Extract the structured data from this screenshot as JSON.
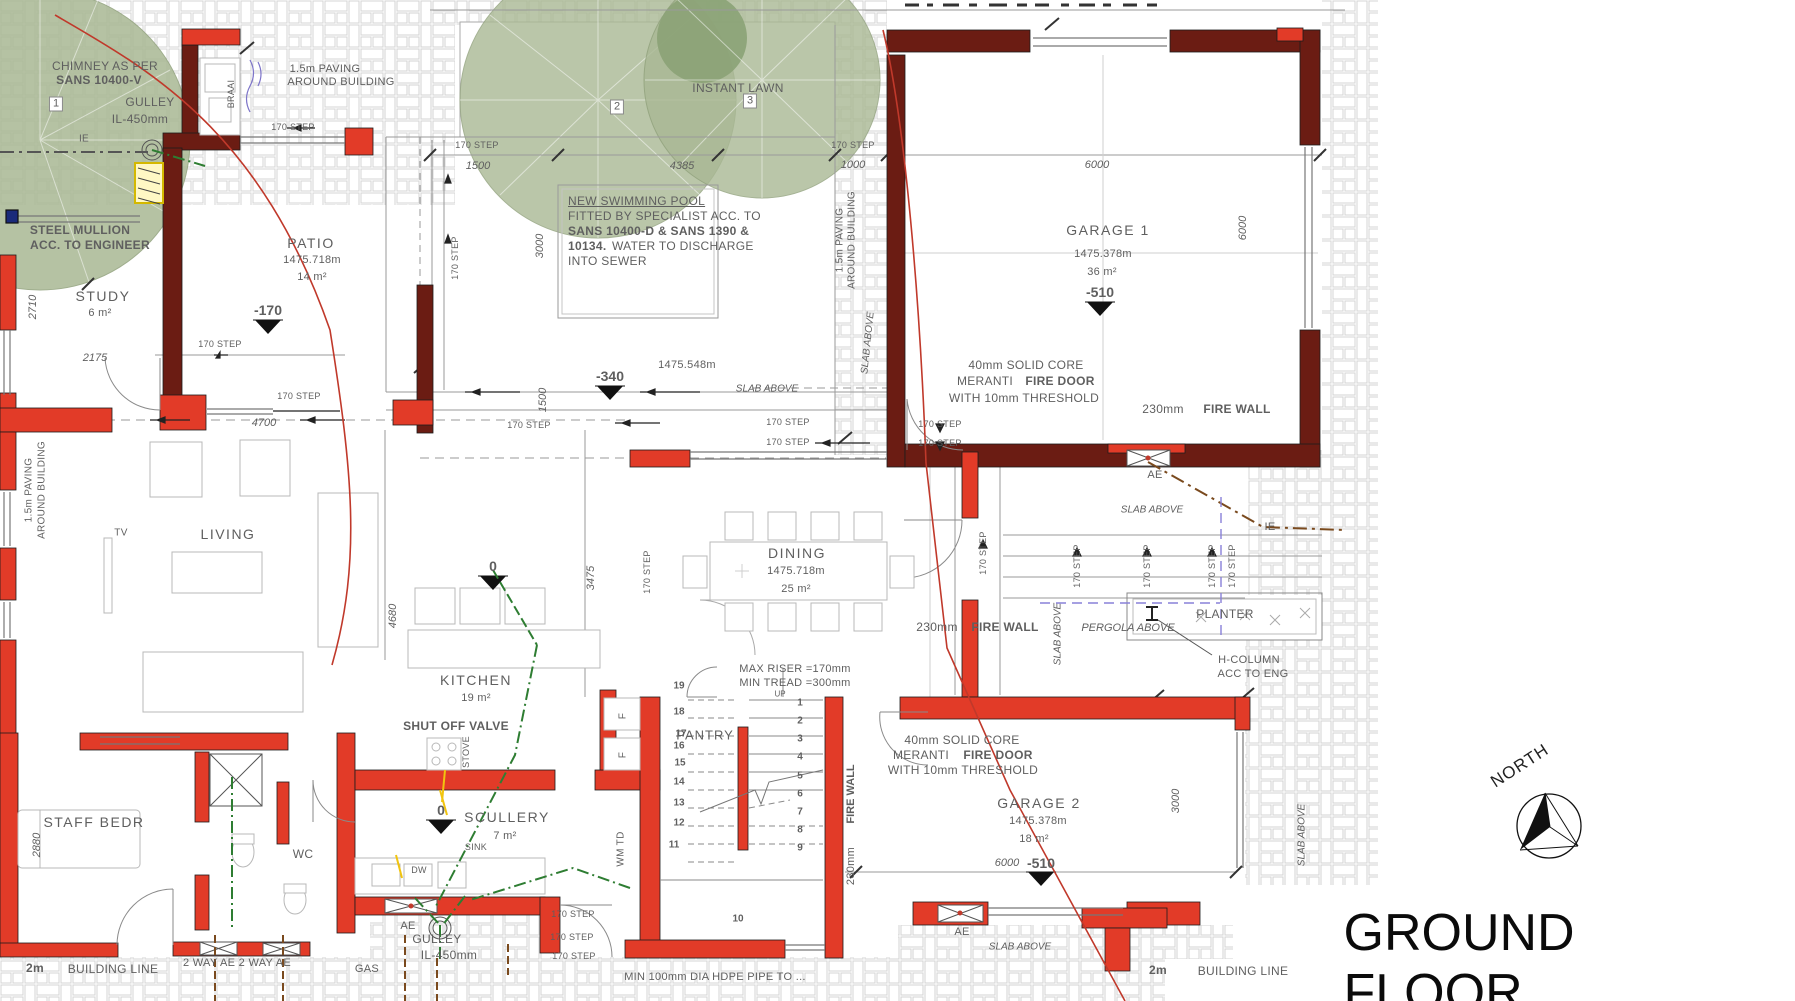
{
  "title": "GROUND FLOOR",
  "north_label": "NORTH",
  "labels": [
    {
      "n": "chimney-note-1",
      "t": "CHIMNEY AS PER",
      "x": 105,
      "y": 66,
      "c": "g12"
    },
    {
      "n": "chimney-note-2",
      "t": "SANS 10400-V",
      "x": 99,
      "y": 80,
      "c": "b12"
    },
    {
      "n": "gulley-1",
      "t": "GULLEY",
      "x": 150,
      "y": 102,
      "c": "g12"
    },
    {
      "n": "gulley-1-il",
      "t": "IL-450mm",
      "x": 140,
      "y": 119,
      "c": "g12"
    },
    {
      "n": "tree-1-tag",
      "t": "1",
      "x": 56,
      "y": 104,
      "c": "boxed"
    },
    {
      "n": "ie-1",
      "t": "IE",
      "x": 84,
      "y": 139,
      "c": "g10"
    },
    {
      "n": "paving-note-1a",
      "t": "1.5m PAVING",
      "x": 325,
      "y": 69,
      "c": "g11"
    },
    {
      "n": "paving-note-1b",
      "t": "AROUND BUILDING",
      "x": 341,
      "y": 82,
      "c": "g11"
    },
    {
      "n": "step-a",
      "t": "170 STEP",
      "x": 293,
      "y": 127,
      "c": "g9"
    },
    {
      "n": "braai",
      "t": "BRAAI",
      "x": 231,
      "y": 94,
      "c": "g9",
      "r": -90
    },
    {
      "n": "mullion-1",
      "t": "STEEL MULLION",
      "x": 80,
      "y": 230,
      "c": "b12"
    },
    {
      "n": "mullion-2",
      "t": "ACC. TO ENGINEER",
      "x": 90,
      "y": 245,
      "c": "b12"
    },
    {
      "n": "room-study",
      "t": "STUDY",
      "x": 103,
      "y": 296,
      "c": "room"
    },
    {
      "n": "study-area",
      "t": "6 m²",
      "x": 100,
      "y": 313,
      "c": "g11"
    },
    {
      "n": "dim-2710",
      "t": "2710",
      "x": 33,
      "y": 307,
      "c": "gi11",
      "r": -90
    },
    {
      "n": "dim-2175",
      "t": "2175",
      "x": 95,
      "y": 358,
      "c": "gi11"
    },
    {
      "n": "room-patio",
      "t": "PATIO",
      "x": 311,
      "y": 243,
      "c": "room"
    },
    {
      "n": "patio-num",
      "t": "1475.718m",
      "x": 312,
      "y": 260,
      "c": "g11"
    },
    {
      "n": "patio-area",
      "t": "14 m²",
      "x": 312,
      "y": 277,
      "c": "g11"
    },
    {
      "n": "level-minus170",
      "t": "-170",
      "x": 268,
      "y": 310,
      "c": "lvl"
    },
    {
      "n": "step-b",
      "t": "170 STEP",
      "x": 220,
      "y": 344,
      "c": "g9"
    },
    {
      "n": "dim-4700",
      "t": "4700",
      "x": 264,
      "y": 423,
      "c": "gi11"
    },
    {
      "n": "step-c",
      "t": "170 STEP",
      "x": 299,
      "y": 396,
      "c": "g9"
    },
    {
      "n": "instant-lawn",
      "t": "INSTANT LAWN",
      "x": 738,
      "y": 88,
      "c": "g12"
    },
    {
      "n": "tree-2-tag",
      "t": "2",
      "x": 617,
      "y": 107,
      "c": "boxed"
    },
    {
      "n": "tree-3-tag",
      "t": "3",
      "x": 750,
      "y": 101,
      "c": "boxed"
    },
    {
      "n": "step-d",
      "t": "170 STEP",
      "x": 477,
      "y": 145,
      "c": "g9"
    },
    {
      "n": "dim-1500",
      "t": "1500",
      "x": 478,
      "y": 166,
      "c": "gi11"
    },
    {
      "n": "dim-4385",
      "t": "4385",
      "x": 682,
      "y": 166,
      "c": "gi11"
    },
    {
      "n": "step-e",
      "t": "170 STEP",
      "x": 853,
      "y": 145,
      "c": "g9"
    },
    {
      "n": "dim-1000",
      "t": "1000",
      "x": 853,
      "y": 165,
      "c": "gi11"
    },
    {
      "n": "pool-note-1",
      "t": "NEW SWIMMING POOL",
      "x": 568,
      "y": 201,
      "c": "gu12 tl"
    },
    {
      "n": "pool-note-2",
      "t": "FITTED BY SPECIALIST ACC. TO",
      "x": 568,
      "y": 216,
      "c": "g12 tl"
    },
    {
      "n": "pool-note-3",
      "t": "SANS 10400-D & SANS 1390 &",
      "x": 568,
      "y": 231,
      "c": "b12 tl"
    },
    {
      "n": "pool-note-4a",
      "t": "10134.",
      "x": 568,
      "y": 246,
      "c": "b12 tl"
    },
    {
      "n": "pool-note-4b",
      "t": "WATER TO DISCHARGE",
      "x": 612,
      "y": 246,
      "c": "g12 tl"
    },
    {
      "n": "pool-note-5",
      "t": "INTO SEWER",
      "x": 568,
      "y": 261,
      "c": "g12 tl"
    },
    {
      "n": "dim-3000-pool",
      "t": "3000",
      "x": 540,
      "y": 246,
      "c": "gi11",
      "r": -90
    },
    {
      "n": "dim-1500-pool",
      "t": "1500",
      "x": 543,
      "y": 400,
      "c": "gi11",
      "r": -90
    },
    {
      "n": "paving-v1a",
      "t": "1.5m PAVING",
      "x": 840,
      "y": 240,
      "c": "g10",
      "r": -90
    },
    {
      "n": "paving-v1b",
      "t": "AROUND BUILDING",
      "x": 852,
      "y": 240,
      "c": "g10",
      "r": -90
    },
    {
      "n": "level-minus340",
      "t": "-340",
      "x": 610,
      "y": 376,
      "c": "lvl"
    },
    {
      "n": "num-1475548",
      "t": "1475.548m",
      "x": 687,
      "y": 365,
      "c": "g11"
    },
    {
      "n": "slab-above-pool",
      "t": "SLAB ABOVE",
      "x": 767,
      "y": 389,
      "c": "gi10"
    },
    {
      "n": "step-f",
      "t": "170 STEP",
      "x": 529,
      "y": 425,
      "c": "g9"
    },
    {
      "n": "step-g",
      "t": "170 STEP",
      "x": 788,
      "y": 422,
      "c": "g9"
    },
    {
      "n": "step-h",
      "t": "170 STEP",
      "x": 788,
      "y": 442,
      "c": "g9"
    },
    {
      "n": "step-i",
      "t": "170 STEP",
      "x": 940,
      "y": 424,
      "c": "g9"
    },
    {
      "n": "step-j",
      "t": "170 STEP",
      "x": 940,
      "y": 443,
      "c": "g9"
    },
    {
      "n": "step-v-a",
      "t": "170 STEP",
      "x": 455,
      "y": 258,
      "c": "g9",
      "r": -90
    },
    {
      "n": "dim-6000-g1",
      "t": "6000",
      "x": 1097,
      "y": 165,
      "c": "gi11"
    },
    {
      "n": "dim-6000-g1v",
      "t": "6000",
      "x": 1243,
      "y": 228,
      "c": "gi11",
      "r": -90
    },
    {
      "n": "room-garage1",
      "t": "GARAGE 1",
      "x": 1108,
      "y": 230,
      "c": "room"
    },
    {
      "n": "garage1-num",
      "t": "1475.378m",
      "x": 1103,
      "y": 254,
      "c": "g11"
    },
    {
      "n": "garage1-area",
      "t": "36 m²",
      "x": 1102,
      "y": 272,
      "c": "g11"
    },
    {
      "n": "level-minus510-g1",
      "t": "-510",
      "x": 1100,
      "y": 292,
      "c": "lvl"
    },
    {
      "n": "firedoor1-1",
      "t": "40mm SOLID CORE",
      "x": 1026,
      "y": 365,
      "c": "g12"
    },
    {
      "n": "firedoor1-2a",
      "t": "MERANTI",
      "x": 985,
      "y": 381,
      "c": "g12"
    },
    {
      "n": "firedoor1-2b",
      "t": "FIRE DOOR",
      "x": 1060,
      "y": 381,
      "c": "b12"
    },
    {
      "n": "firedoor1-3",
      "t": "WITH 10mm THRESHOLD",
      "x": 1024,
      "y": 398,
      "c": "g12"
    },
    {
      "n": "firewall-g1-a",
      "t": "230mm",
      "x": 1163,
      "y": 409,
      "c": "g12"
    },
    {
      "n": "firewall-g1-b",
      "t": "FIRE WALL",
      "x": 1237,
      "y": 409,
      "c": "b12"
    },
    {
      "n": "slab-above-g1",
      "t": "SLAB ABOVE",
      "x": 868,
      "y": 343,
      "c": "gi10",
      "r": -84
    },
    {
      "n": "ae-court",
      "t": "AE",
      "x": 1155,
      "y": 475,
      "c": "g11"
    },
    {
      "n": "slab-above-court",
      "t": "SLAB ABOVE",
      "x": 1152,
      "y": 510,
      "c": "gi10"
    },
    {
      "n": "ie-2",
      "t": "IE",
      "x": 1270,
      "y": 527,
      "c": "g11"
    },
    {
      "n": "step-v-b",
      "t": "170 STEP",
      "x": 983,
      "y": 553,
      "c": "g9",
      "r": -90
    },
    {
      "n": "step-v-c",
      "t": "170 STEP",
      "x": 1077,
      "y": 566,
      "c": "g9",
      "r": -90
    },
    {
      "n": "step-v-d",
      "t": "170 STEP",
      "x": 1147,
      "y": 566,
      "c": "g9",
      "r": -90
    },
    {
      "n": "step-v-e",
      "t": "170 STEP",
      "x": 1212,
      "y": 566,
      "c": "g9",
      "r": -90
    },
    {
      "n": "step-v-f",
      "t": "170 STEP",
      "x": 1232,
      "y": 566,
      "c": "g9",
      "r": -90
    },
    {
      "n": "slab-above-v2",
      "t": "SLAB ABOVE",
      "x": 1058,
      "y": 634,
      "c": "gi10",
      "r": -90
    },
    {
      "n": "pergola",
      "t": "PERGOLA ABOVE",
      "x": 1128,
      "y": 628,
      "c": "gi11"
    },
    {
      "n": "planter",
      "t": "PLANTER",
      "x": 1225,
      "y": 614,
      "c": "g12"
    },
    {
      "n": "hcolumn-1",
      "t": "H-COLUMN",
      "x": 1249,
      "y": 660,
      "c": "g11"
    },
    {
      "n": "hcolumn-2",
      "t": "ACC TO ENG",
      "x": 1253,
      "y": 674,
      "c": "g11"
    },
    {
      "n": "tv",
      "t": "TV",
      "x": 121,
      "y": 533,
      "c": "g10"
    },
    {
      "n": "room-living",
      "t": "LIVING",
      "x": 228,
      "y": 534,
      "c": "room"
    },
    {
      "n": "dim-4680",
      "t": "4680",
      "x": 393,
      "y": 616,
      "c": "gi11",
      "r": -90
    },
    {
      "n": "room-dining",
      "t": "DINING",
      "x": 797,
      "y": 553,
      "c": "room"
    },
    {
      "n": "dining-num",
      "t": "1475.718m",
      "x": 796,
      "y": 571,
      "c": "g11"
    },
    {
      "n": "dining-area",
      "t": "25 m²",
      "x": 796,
      "y": 589,
      "c": "g11"
    },
    {
      "n": "dim-3475",
      "t": "3475",
      "x": 591,
      "y": 578,
      "c": "gi11",
      "r": -90
    },
    {
      "n": "step-v-g",
      "t": "170 STEP",
      "x": 647,
      "y": 572,
      "c": "g9",
      "r": -90
    },
    {
      "n": "room-kitchen",
      "t": "KITCHEN",
      "x": 476,
      "y": 680,
      "c": "room"
    },
    {
      "n": "kitchen-area",
      "t": "19 m²",
      "x": 476,
      "y": 698,
      "c": "g11"
    },
    {
      "n": "shutoff-valve",
      "t": "SHUT OFF VALVE",
      "x": 456,
      "y": 726,
      "c": "b12"
    },
    {
      "n": "stove",
      "t": "STOVE",
      "x": 466,
      "y": 752,
      "c": "g9",
      "r": -90
    },
    {
      "n": "room-scullery",
      "t": "SCULLERY",
      "x": 507,
      "y": 817,
      "c": "room"
    },
    {
      "n": "scullery-area",
      "t": "7 m²",
      "x": 505,
      "y": 836,
      "c": "g11"
    },
    {
      "n": "level-0-scullery",
      "t": "0",
      "x": 441,
      "y": 810,
      "c": "lvl"
    },
    {
      "n": "sink",
      "t": "SINK",
      "x": 476,
      "y": 847,
      "c": "g9"
    },
    {
      "n": "dw",
      "t": "DW",
      "x": 419,
      "y": 870,
      "c": "g9"
    },
    {
      "n": "level-0-kitchen",
      "t": "0",
      "x": 493,
      "y": 566,
      "c": "lvl"
    },
    {
      "n": "max-riser",
      "t": "MAX RISER =170mm",
      "x": 795,
      "y": 669,
      "c": "g11"
    },
    {
      "n": "min-tread",
      "t": "MIN TREAD =300mm",
      "x": 795,
      "y": 683,
      "c": "g11"
    },
    {
      "n": "up",
      "t": "UP",
      "x": 780,
      "y": 694,
      "c": "g8"
    },
    {
      "n": "room-pantry",
      "t": "PANTRY",
      "x": 705,
      "y": 735,
      "c": "g13"
    },
    {
      "n": "wm-td",
      "t": "WM TD",
      "x": 621,
      "y": 849,
      "c": "g10",
      "r": -90
    },
    {
      "n": "fridge-f1",
      "t": "F",
      "x": 623,
      "y": 716,
      "c": "g10",
      "r": -90
    },
    {
      "n": "fridge-f2",
      "t": "F",
      "x": 623,
      "y": 755,
      "c": "g10",
      "r": -90
    },
    {
      "n": "stair-1",
      "t": "1",
      "x": 800,
      "y": 703,
      "c": "st"
    },
    {
      "n": "stair-2",
      "t": "2",
      "x": 800,
      "y": 721,
      "c": "st"
    },
    {
      "n": "stair-3",
      "t": "3",
      "x": 800,
      "y": 739,
      "c": "st"
    },
    {
      "n": "stair-4",
      "t": "4",
      "x": 800,
      "y": 757,
      "c": "st"
    },
    {
      "n": "stair-5",
      "t": "5",
      "x": 800,
      "y": 776,
      "c": "st"
    },
    {
      "n": "stair-6",
      "t": "6",
      "x": 800,
      "y": 794,
      "c": "st"
    },
    {
      "n": "stair-7",
      "t": "7",
      "x": 800,
      "y": 812,
      "c": "st"
    },
    {
      "n": "stair-8",
      "t": "8",
      "x": 800,
      "y": 830,
      "c": "st"
    },
    {
      "n": "stair-9",
      "t": "9",
      "x": 800,
      "y": 848,
      "c": "st"
    },
    {
      "n": "stair-19",
      "t": "19",
      "x": 679,
      "y": 686,
      "c": "st"
    },
    {
      "n": "stair-18",
      "t": "18",
      "x": 679,
      "y": 712,
      "c": "st"
    },
    {
      "n": "stair-17",
      "t": "17",
      "x": 681,
      "y": 734,
      "c": "st"
    },
    {
      "n": "stair-16",
      "t": "16",
      "x": 679,
      "y": 746,
      "c": "st"
    },
    {
      "n": "stair-15",
      "t": "15",
      "x": 680,
      "y": 763,
      "c": "st"
    },
    {
      "n": "stair-14",
      "t": "14",
      "x": 679,
      "y": 782,
      "c": "st"
    },
    {
      "n": "stair-13",
      "t": "13",
      "x": 679,
      "y": 803,
      "c": "st"
    },
    {
      "n": "stair-12",
      "t": "12",
      "x": 679,
      "y": 823,
      "c": "st"
    },
    {
      "n": "stair-11",
      "t": "11",
      "x": 674,
      "y": 845,
      "c": "st"
    },
    {
      "n": "stair-10",
      "t": "10",
      "x": 738,
      "y": 919,
      "c": "st"
    },
    {
      "n": "step-k",
      "t": "170 STEP",
      "x": 573,
      "y": 914,
      "c": "g9"
    },
    {
      "n": "step-l",
      "t": "170 STEP",
      "x": 572,
      "y": 937,
      "c": "g9"
    },
    {
      "n": "step-m",
      "t": "170 STEP",
      "x": 574,
      "y": 956,
      "c": "g9"
    },
    {
      "n": "firewall-g2v-a",
      "t": "230mm",
      "x": 851,
      "y": 866,
      "c": "g11",
      "r": -90
    },
    {
      "n": "firewall-g2v-b",
      "t": "FIRE WALL",
      "x": 851,
      "y": 794,
      "c": "b11",
      "r": -90
    },
    {
      "n": "firedoor2-1",
      "t": "40mm SOLID CORE",
      "x": 962,
      "y": 740,
      "c": "g12"
    },
    {
      "n": "firedoor2-2a",
      "t": "MERANTI",
      "x": 921,
      "y": 755,
      "c": "g12"
    },
    {
      "n": "firedoor2-2b",
      "t": "FIRE DOOR",
      "x": 998,
      "y": 755,
      "c": "b12"
    },
    {
      "n": "firedoor2-3",
      "t": "WITH 10mm THRESHOLD",
      "x": 963,
      "y": 770,
      "c": "g12"
    },
    {
      "n": "firewall-g2h-a",
      "t": "230mm",
      "x": 937,
      "y": 627,
      "c": "g12"
    },
    {
      "n": "firewall-g2h-b",
      "t": "FIRE WALL",
      "x": 1005,
      "y": 627,
      "c": "b12"
    },
    {
      "n": "room-garage2",
      "t": "GARAGE 2",
      "x": 1039,
      "y": 803,
      "c": "room"
    },
    {
      "n": "garage2-num",
      "t": "1475.378m",
      "x": 1038,
      "y": 821,
      "c": "g11"
    },
    {
      "n": "garage2-area",
      "t": "18 m²",
      "x": 1034,
      "y": 839,
      "c": "g11"
    },
    {
      "n": "dim-6000-g2",
      "t": "6000",
      "x": 1007,
      "y": 863,
      "c": "gi11"
    },
    {
      "n": "level-minus510-g2",
      "t": "-510",
      "x": 1041,
      "y": 863,
      "c": "lvl"
    },
    {
      "n": "ae-g2",
      "t": "AE",
      "x": 962,
      "y": 932,
      "c": "g11"
    },
    {
      "n": "slab-above-g2",
      "t": "SLAB ABOVE",
      "x": 1020,
      "y": 947,
      "c": "gi10"
    },
    {
      "n": "dim-3000-g2",
      "t": "3000",
      "x": 1176,
      "y": 801,
      "c": "gi11",
      "r": -90
    },
    {
      "n": "slab-above-right",
      "t": "SLAB ABOVE",
      "x": 1302,
      "y": 835,
      "c": "gi10",
      "r": -90
    },
    {
      "n": "room-staff-bedr",
      "t": "STAFF BEDR",
      "x": 94,
      "y": 822,
      "c": "room"
    },
    {
      "n": "dim-2880",
      "t": "2880",
      "x": 37,
      "y": 845,
      "c": "gi11",
      "r": -90
    },
    {
      "n": "room-wc",
      "t": "WC",
      "x": 303,
      "y": 854,
      "c": "g12"
    },
    {
      "n": "building-line-1a",
      "t": "2m",
      "x": 35,
      "y": 968,
      "c": "b12"
    },
    {
      "n": "building-line-1b",
      "t": "BUILDING LINE",
      "x": 113,
      "y": 969,
      "c": "g12"
    },
    {
      "n": "two-way-ae",
      "t": "2 WAY AE 2 WAY AE",
      "x": 237,
      "y": 963,
      "c": "g11"
    },
    {
      "n": "gas",
      "t": "GAS",
      "x": 367,
      "y": 969,
      "c": "g11"
    },
    {
      "n": "ae-scullery",
      "t": "AE",
      "x": 408,
      "y": 926,
      "c": "g11"
    },
    {
      "n": "gulley-2",
      "t": "GULLEY",
      "x": 437,
      "y": 939,
      "c": "g12"
    },
    {
      "n": "gulley-2-il",
      "t": "IL-450mm",
      "x": 449,
      "y": 955,
      "c": "g12"
    },
    {
      "n": "hdpe-note",
      "t": "MIN 100mm DIA HDPE PIPE TO ...",
      "x": 715,
      "y": 977,
      "c": "g11"
    },
    {
      "n": "building-line-2a",
      "t": "2m",
      "x": 1158,
      "y": 970,
      "c": "b12"
    },
    {
      "n": "building-line-2b",
      "t": "BUILDING LINE",
      "x": 1243,
      "y": 971,
      "c": "g12"
    },
    {
      "n": "paving-v2a",
      "t": "1.5m PAVING",
      "x": 29,
      "y": 490,
      "c": "g10",
      "r": -90
    },
    {
      "n": "paving-v2b",
      "t": "AROUND BUILDING",
      "x": 42,
      "y": 490,
      "c": "g10",
      "r": -90
    }
  ]
}
